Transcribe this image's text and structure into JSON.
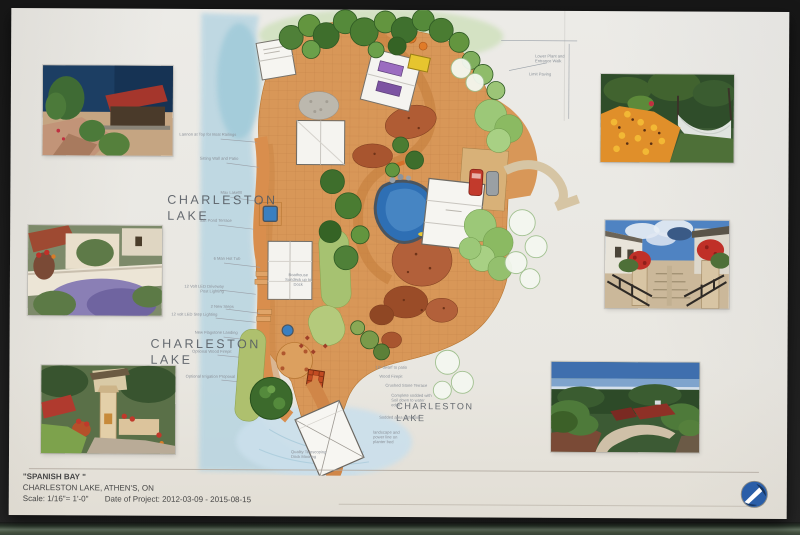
{
  "scene": {
    "setting": "photograph of a printed landscape site-plan presentation board on a dark wall",
    "wall_color": "#1d1d1d",
    "shelf_color": "#61705f",
    "paper_color": "#e9e7e1"
  },
  "title_block": {
    "project_name": "\"SPANISH BAY \"",
    "location": "CHARLESTON LAKE, ATHEN'S, ON",
    "scale_label": "Scale: 1/16\"= 1'-0\"",
    "date_label": "Date of Project: 2012-03-09 - 2015-08-15"
  },
  "logo": {
    "name": "design-firm-logo",
    "bg": "#2a5ea8",
    "swoosh": "#ffffff",
    "accent": "#16355f"
  },
  "plan": {
    "lake_labels": [
      {
        "line1": "CHARLESTON",
        "line2": "LAKE"
      },
      {
        "line1": "CHARLESTON",
        "line2": "LAKE"
      },
      {
        "line1": "CHARLESTON",
        "line2": "LAKE"
      }
    ],
    "annotations": [
      {
        "text": "Lannon at Top for Boat Railings"
      },
      {
        "text": "Sitting Wall and Patio"
      },
      {
        "text": "Max Lakefill"
      },
      {
        "text": "Salt Pond Terrace"
      },
      {
        "text": "6 Man Hot Tub"
      },
      {
        "text": "12 Volt LED Driveway Post Lighting"
      },
      {
        "text": "2 New Steps"
      },
      {
        "text": "12 volt LED Step Lighting"
      },
      {
        "text": "New Flagstone Landing"
      },
      {
        "text": "Optional Wood Firepit"
      },
      {
        "text": "Optional Irrigation Proposal"
      },
      {
        "text": "Boathouse Sundeck up to Dock"
      },
      {
        "text": "Lower Plant and Entrance Walk"
      },
      {
        "text": "Limit Paving"
      },
      {
        "text": "18\" dwarf to patio"
      },
      {
        "text": "Wood Firepit"
      },
      {
        "text": "Crushed Stone Terrace"
      },
      {
        "text": "Complete sodded with Soil down to water edge"
      },
      {
        "text": "Sodded area with Soil"
      },
      {
        "text": "Quality Telescoping Dock Mooring"
      },
      {
        "text": "landscape and power line on planter bed"
      }
    ],
    "colors": {
      "paving": "#d89758",
      "deck": "#d98e4d",
      "water": "#b5d4e2",
      "pool": "#2e6fb4",
      "tree_dark": "#3e6e2c",
      "tree_light": "#9cc878",
      "groundcover_rust": "#b05c34",
      "lawn": "#aec06e",
      "roof_white": "#f6f5f1"
    }
  },
  "photos": [
    {
      "name": "photo-lakeside-boathouse",
      "description": "red-roofed boathouse at rocky lake shore"
    },
    {
      "name": "photo-lavender-courtyard",
      "description": "white stucco wall, tile roof and lavender"
    },
    {
      "name": "photo-garden-pillars",
      "description": "stucco pillars, potted red flowers and lawn"
    },
    {
      "name": "photo-flowers-hammock",
      "description": "orange flower bed beside a white hammock"
    },
    {
      "name": "photo-stair-flowers",
      "description": "stone stairway with iron railings and red geraniums"
    },
    {
      "name": "photo-forest-walkway",
      "description": "curved walkway to red-roofed buildings in forest"
    }
  ]
}
